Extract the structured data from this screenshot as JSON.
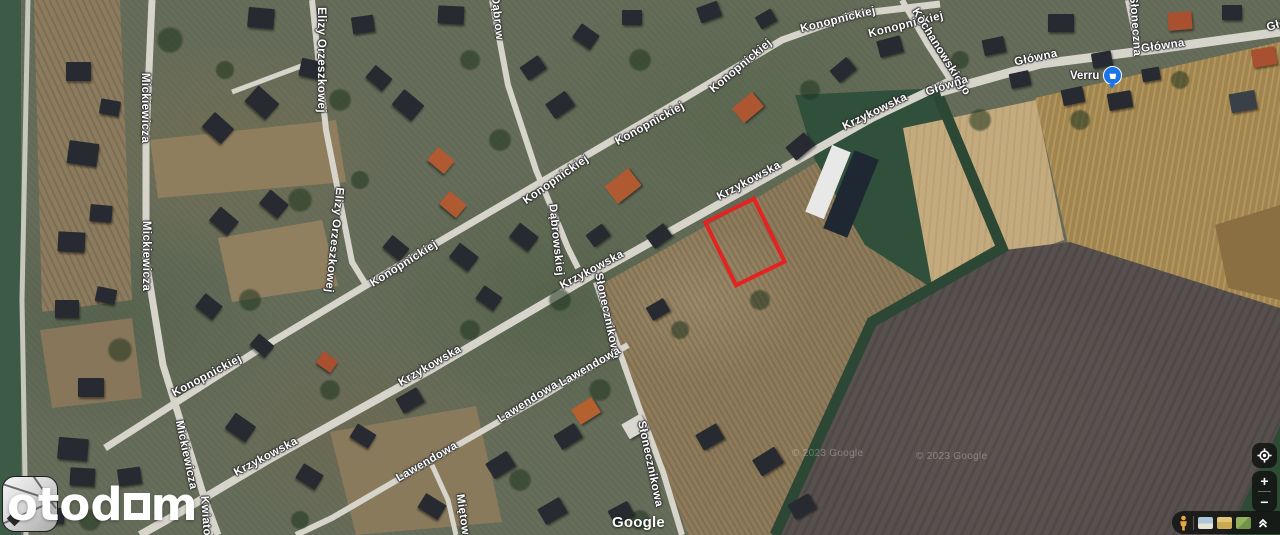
{
  "map": {
    "street_labels": [
      {
        "text": "Mickiewicza",
        "x": 145,
        "y": 108,
        "rot": 90
      },
      {
        "text": "Mickiewicza",
        "x": 146,
        "y": 256,
        "rot": 90
      },
      {
        "text": "Mickiewicza",
        "x": 186,
        "y": 455,
        "rot": 78
      },
      {
        "text": "Elizy Orzeszkowej",
        "x": 321,
        "y": 60,
        "rot": 90
      },
      {
        "text": "Elizy Orzeszkowej",
        "x": 334,
        "y": 240,
        "rot": 96
      },
      {
        "text": "Konopnickiej",
        "x": 207,
        "y": 376,
        "rot": -28
      },
      {
        "text": "Konopnickiej",
        "x": 404,
        "y": 264,
        "rot": -32
      },
      {
        "text": "Konopnickiej",
        "x": 556,
        "y": 180,
        "rot": -35
      },
      {
        "text": "Konopnickiej",
        "x": 650,
        "y": 124,
        "rot": -29
      },
      {
        "text": "Konopnickiej",
        "x": 741,
        "y": 66,
        "rot": -40
      },
      {
        "text": "Konopnickiej",
        "x": 838,
        "y": 20,
        "rot": -14
      },
      {
        "text": "Konopnickiej",
        "x": 906,
        "y": 25,
        "rot": -14
      },
      {
        "text": "Dąbrow",
        "x": 497,
        "y": 18,
        "rot": 84
      },
      {
        "text": "Dąbrowskiej",
        "x": 556,
        "y": 240,
        "rot": 84
      },
      {
        "text": "Krzykowska",
        "x": 875,
        "y": 112,
        "rot": -26
      },
      {
        "text": "Krzykowska",
        "x": 749,
        "y": 181,
        "rot": -28
      },
      {
        "text": "Krzykowska",
        "x": 592,
        "y": 270,
        "rot": -28
      },
      {
        "text": "Krzykowska",
        "x": 430,
        "y": 366,
        "rot": -30
      },
      {
        "text": "Krzykowska",
        "x": 266,
        "y": 457,
        "rot": -28
      },
      {
        "text": "Kochanowskiego",
        "x": 941,
        "y": 52,
        "rot": 58
      },
      {
        "text": "Główna",
        "x": 947,
        "y": 86,
        "rot": -18
      },
      {
        "text": "Główna",
        "x": 1036,
        "y": 58,
        "rot": -12
      },
      {
        "text": "Główna",
        "x": 1163,
        "y": 46,
        "rot": -8
      },
      {
        "text": "Główna",
        "x": 1288,
        "y": 22,
        "rot": -16
      },
      {
        "text": "Słoneczna",
        "x": 1135,
        "y": 26,
        "rot": 86
      },
      {
        "text": "Słonecznikowa",
        "x": 607,
        "y": 316,
        "rot": 78
      },
      {
        "text": "Słonecznikowa",
        "x": 650,
        "y": 464,
        "rot": 78
      },
      {
        "text": "Lawendowa",
        "x": 590,
        "y": 367,
        "rot": -30
      },
      {
        "text": "Lawendowa",
        "x": 528,
        "y": 402,
        "rot": -32
      },
      {
        "text": "Lawendowa",
        "x": 427,
        "y": 462,
        "rot": -30
      },
      {
        "text": "Miętowa",
        "x": 463,
        "y": 518,
        "rot": 82
      },
      {
        "text": "Kwiatowa",
        "x": 206,
        "y": 524,
        "rot": 86
      }
    ],
    "poi_verru": {
      "label": "Verru"
    },
    "google_watermark": "Google",
    "copyrights": [
      "© 2023 Google",
      "© 2023 Google"
    ],
    "parcel_color": "#e52222"
  },
  "branding": {
    "wordmark_pre": "otod",
    "wordmark_post": "m"
  },
  "controls": {
    "zoom_in": "+",
    "zoom_out": "−"
  }
}
